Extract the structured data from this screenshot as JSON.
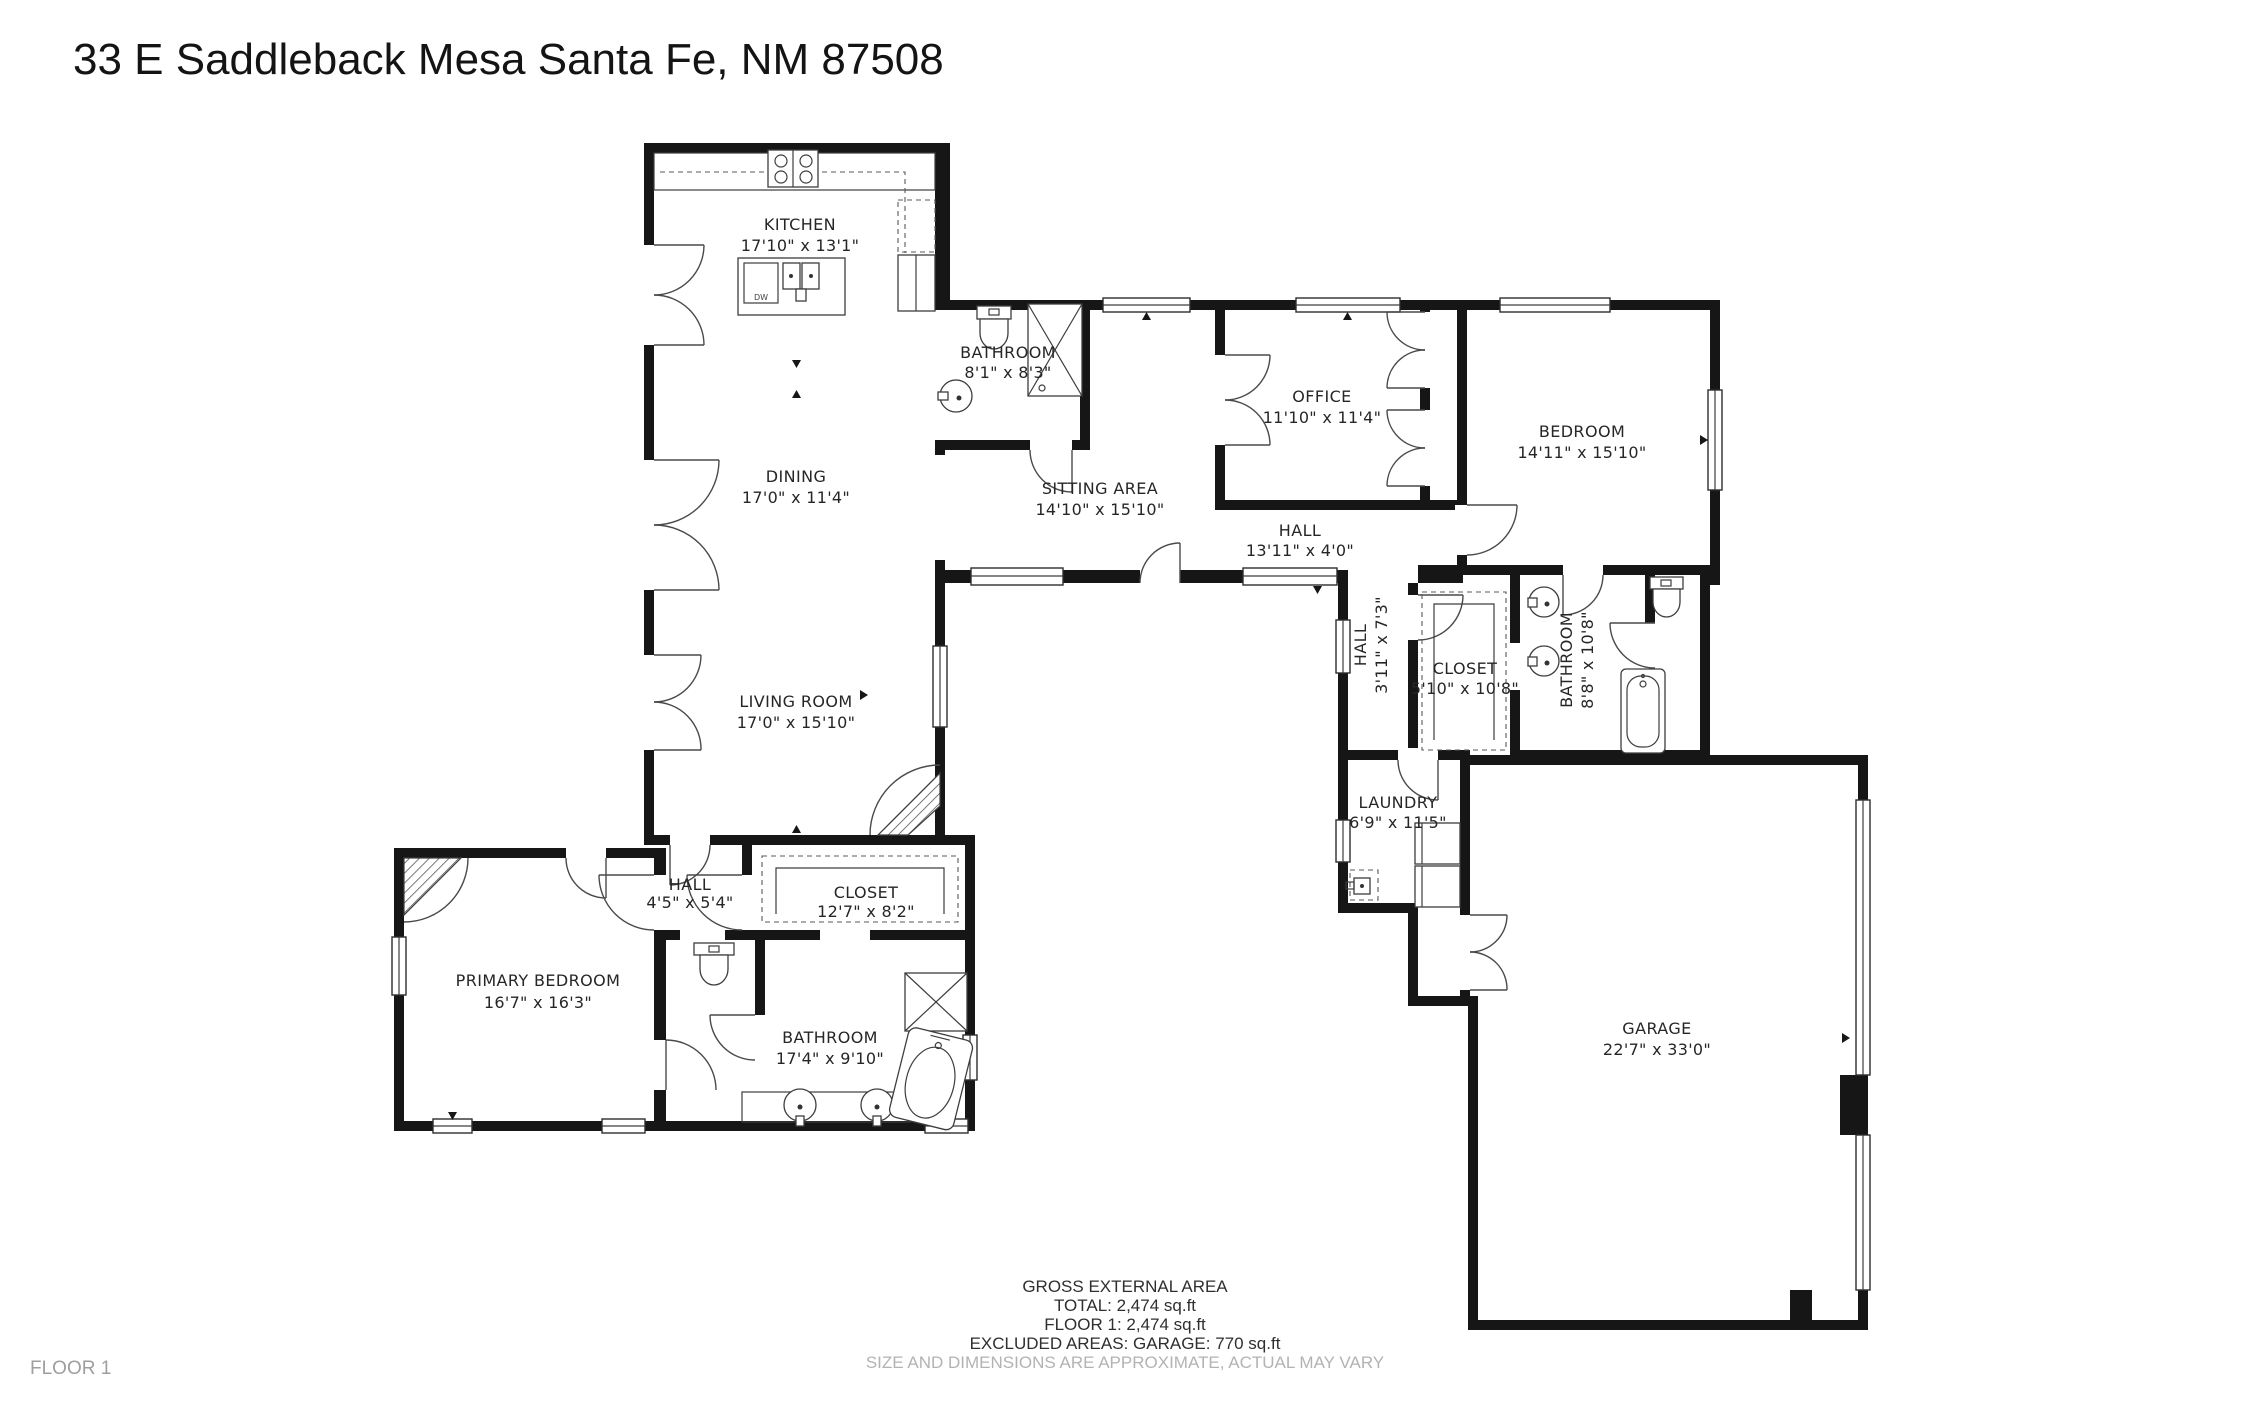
{
  "title": "33 E Saddleback Mesa Santa Fe, NM 87508",
  "floor_label": "FLOOR 1",
  "summary": {
    "heading": "GROSS EXTERNAL AREA",
    "total": "TOTAL: 2,474 sq.ft",
    "floor1": "FLOOR 1: 2,474 sq.ft",
    "excluded": "EXCLUDED AREAS: GARAGE: 770 sq.ft",
    "disclaimer": "SIZE AND DIMENSIONS ARE APPROXIMATE, ACTUAL MAY VARY"
  },
  "fixtures": {
    "dw_label": "DW"
  },
  "colors": {
    "wall": "#161616",
    "label": "#262626",
    "muted": "#b3b3b3"
  },
  "rooms": {
    "kitchen": {
      "name": "KITCHEN",
      "dims": "17'10\" x 13'1\""
    },
    "dining": {
      "name": "DINING",
      "dims": "17'0\" x 11'4\""
    },
    "living_room": {
      "name": "LIVING ROOM",
      "dims": "17'0\" x 15'10\""
    },
    "bathroom_main": {
      "name": "BATHROOM",
      "dims": "8'1\" x 8'3\""
    },
    "sitting_area": {
      "name": "SITTING AREA",
      "dims": "14'10\" x 15'10\""
    },
    "office": {
      "name": "OFFICE",
      "dims": "11'10\" x 11'4\""
    },
    "bedroom": {
      "name": "BEDROOM",
      "dims": "14'11\" x 15'10\""
    },
    "hall_main": {
      "name": "HALL",
      "dims": "13'11\" x 4'0\""
    },
    "hall_small": {
      "name": "HALL",
      "dims": "3'11\" x 7'3\""
    },
    "closet_bedroom": {
      "name": "CLOSET",
      "dims": "5'10\" x 10'8\""
    },
    "bathroom_bedroom": {
      "name": "BATHROOM",
      "dims": "8'8\" x 10'8\""
    },
    "laundry": {
      "name": "LAUNDRY",
      "dims": "6'9\" x 11'5\""
    },
    "garage": {
      "name": "GARAGE",
      "dims": "22'7\" x 33'0\""
    },
    "primary_bedroom": {
      "name": "PRIMARY BEDROOM",
      "dims": "16'7\" x 16'3\""
    },
    "hall_primary": {
      "name": "HALL",
      "dims": "4'5\" x 5'4\""
    },
    "closet_primary": {
      "name": "CLOSET",
      "dims": "12'7\" x 8'2\""
    },
    "bathroom_primary": {
      "name": "BATHROOM",
      "dims": "17'4\" x 9'10\""
    }
  }
}
